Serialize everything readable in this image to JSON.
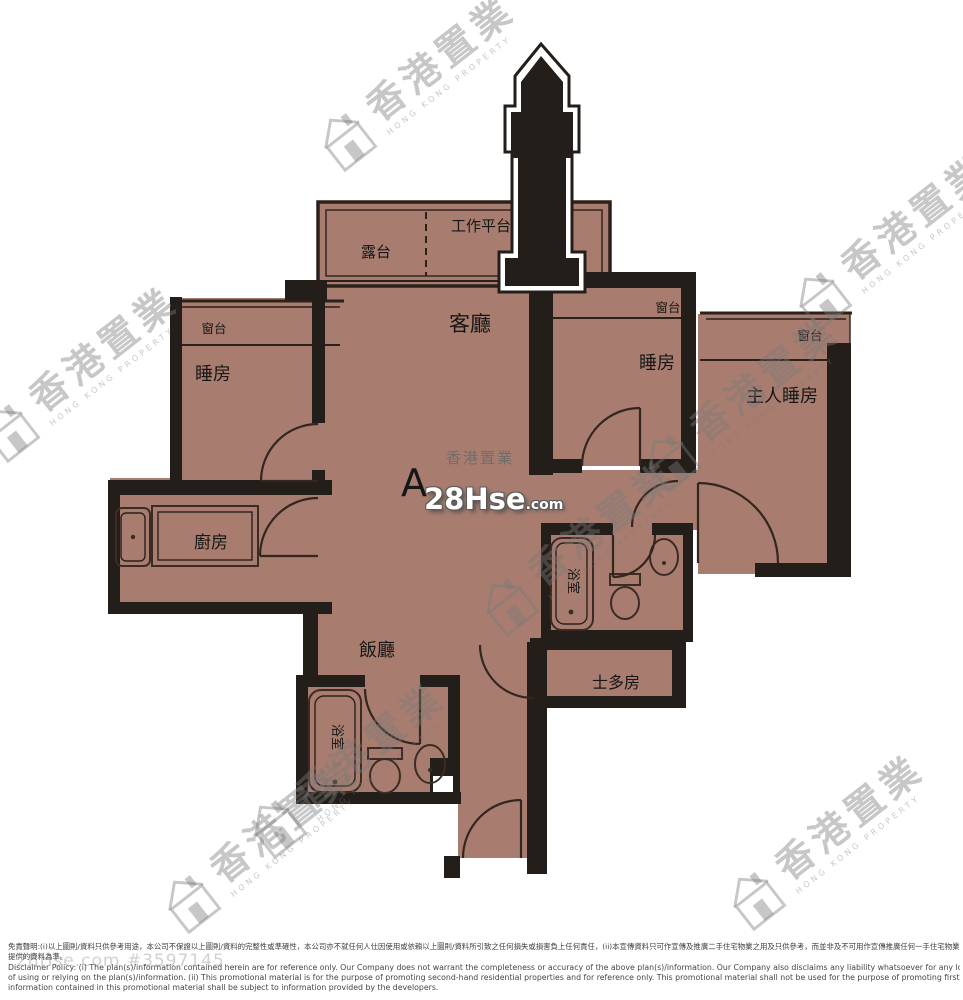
{
  "floor_plan": {
    "unit": "A",
    "rooms": {
      "balcony": "露台",
      "work_platform": "工作平台",
      "living_room": "客廳",
      "dining_room": "飯廳",
      "bedroom_left": "睡房",
      "bedroom_middle": "睡房",
      "master_bedroom": "主人睡房",
      "kitchen": "廚房",
      "bathroom_1": "浴室",
      "bathroom_2": "浴室",
      "store_room": "士多房",
      "bay_window_left": "窗台",
      "bay_window_middle": "窗台",
      "bay_window_right": "窗台"
    }
  },
  "watermark": {
    "cn": "香港置業",
    "en": "HONG KONG PROPERTY"
  },
  "center_logo": {
    "site_cn": "香港置業",
    "brand": "28Hse",
    "tld": ".com"
  },
  "footer": {
    "ref": "28Hse.com #3597145",
    "disclaimer_cn_1": "免責聲明:(i)以上圖則/資料只供參考用途，本公司不保證以上圖則/資料的完整性或準確性，本公司亦不就任何人仕因使用或依賴以上圖則/資料所引致之任何損失或損害負上任何責任，(ii)本宣傳資料只可作宣傳及推廣二手住宅物業之用及只供參考，而並非及不可用作宣傳推廣任何一手住宅物業，其準確性及真實性以發展商",
    "disclaimer_cn_2": "提供的資料為準。",
    "disclaimer_en_1": "Disclaimer Policy: (i) The plan(s)/information contained herein are for reference only. Our Company does not warrant the completeness or accuracy of the above plan(s)/information. Our Company also disclaims any liability whatsoever for any loss or damage suffered or to be suffered by any person as a result",
    "disclaimer_en_2": "of using or relying on the plan(s)/information. (ii) This promotional material is for the purpose of promoting second-hand residential properties and for reference only. This promotional material shall not be used for the purpose of promoting first-hand residential properties. The accuracy and truth of the",
    "disclaimer_en_3": "information contained in this promotional material shall be subject to information provided by the developers."
  },
  "colors": {
    "floor": "#a87d6f",
    "wall": "#241e1a",
    "watermark_gray": "#7a7a7a",
    "logo_white": "#ffffff"
  }
}
